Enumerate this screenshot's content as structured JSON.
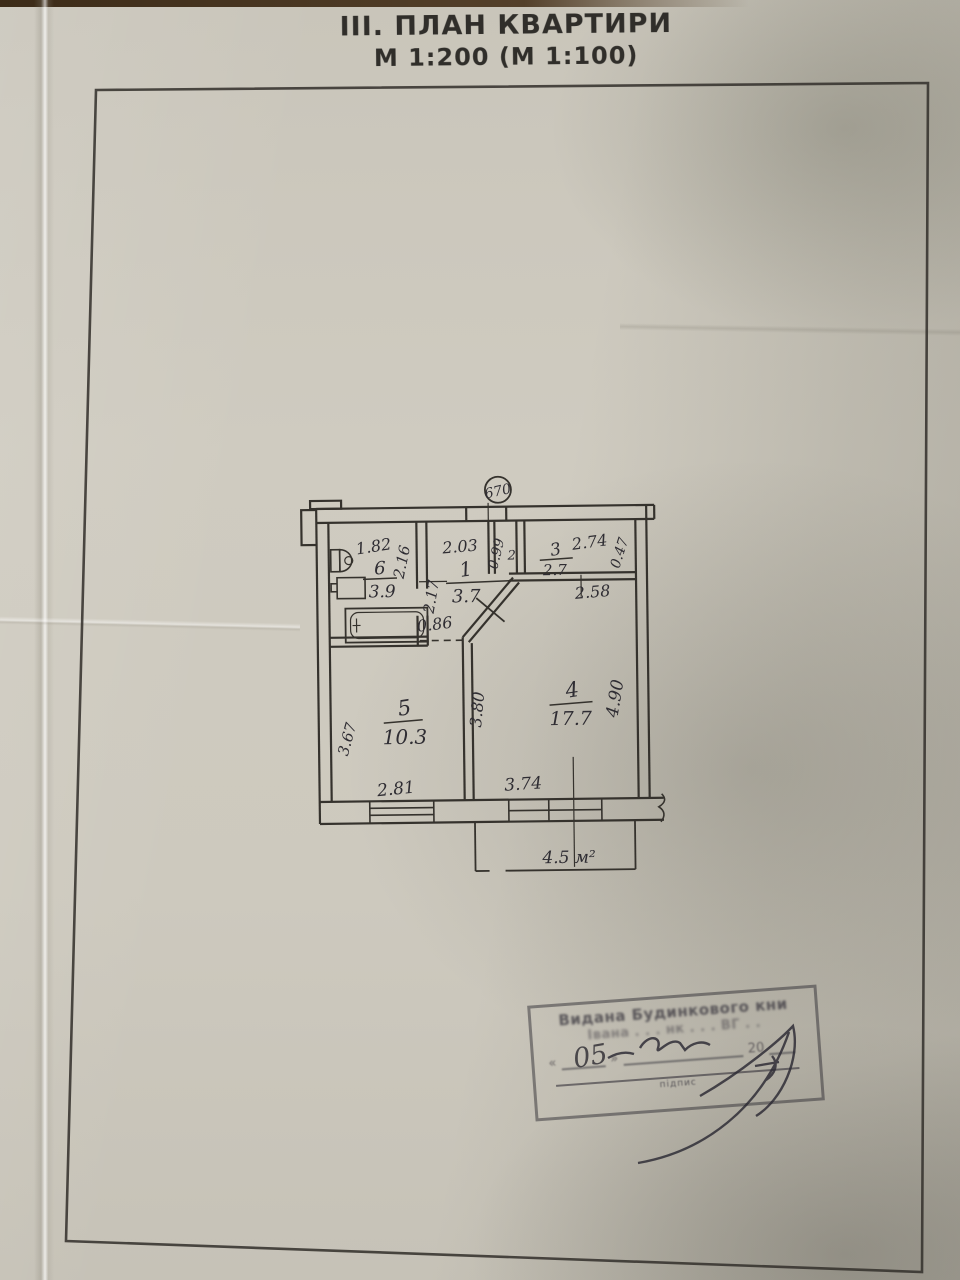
{
  "page": {
    "title_line1": "III. ПЛАН КВАРТИРИ",
    "title_line2": "М 1:200 (М 1:100)"
  },
  "plan": {
    "building_number": "670",
    "rooms": {
      "r1": {
        "num": "1",
        "area": "3.7"
      },
      "r2": {
        "num": "2"
      },
      "r3": {
        "num": "3",
        "area": "2.7"
      },
      "r4": {
        "num": "4",
        "area": "17.7"
      },
      "r5": {
        "num": "5",
        "area": "10.3"
      },
      "r6": {
        "num": "6",
        "area": "3.9"
      }
    },
    "balcony_area": "4.5 м²",
    "dims": {
      "bath_top": "1.82",
      "bath_right": "2.16",
      "hall_top": "2.03",
      "hall_left": "2.17",
      "hall_bottom": "0.86",
      "closet_left": "0.99",
      "r3_top": "2.74",
      "r3_right": "0.47",
      "r3_bottom": "2.58",
      "r5_left": "3.67",
      "r5_bottom": "2.81",
      "r4_left": "3.80",
      "r4_bottom": "3.74",
      "r4_right": "4.90"
    }
  },
  "stamp": {
    "line1": "Видана Будинкового кни",
    "line2": "Івана . . . нк . . . ВГ . .",
    "quote_open": "«",
    "quote_close": "»",
    "year": "20",
    "caption": "підпис",
    "handwritten_day": "05"
  }
}
